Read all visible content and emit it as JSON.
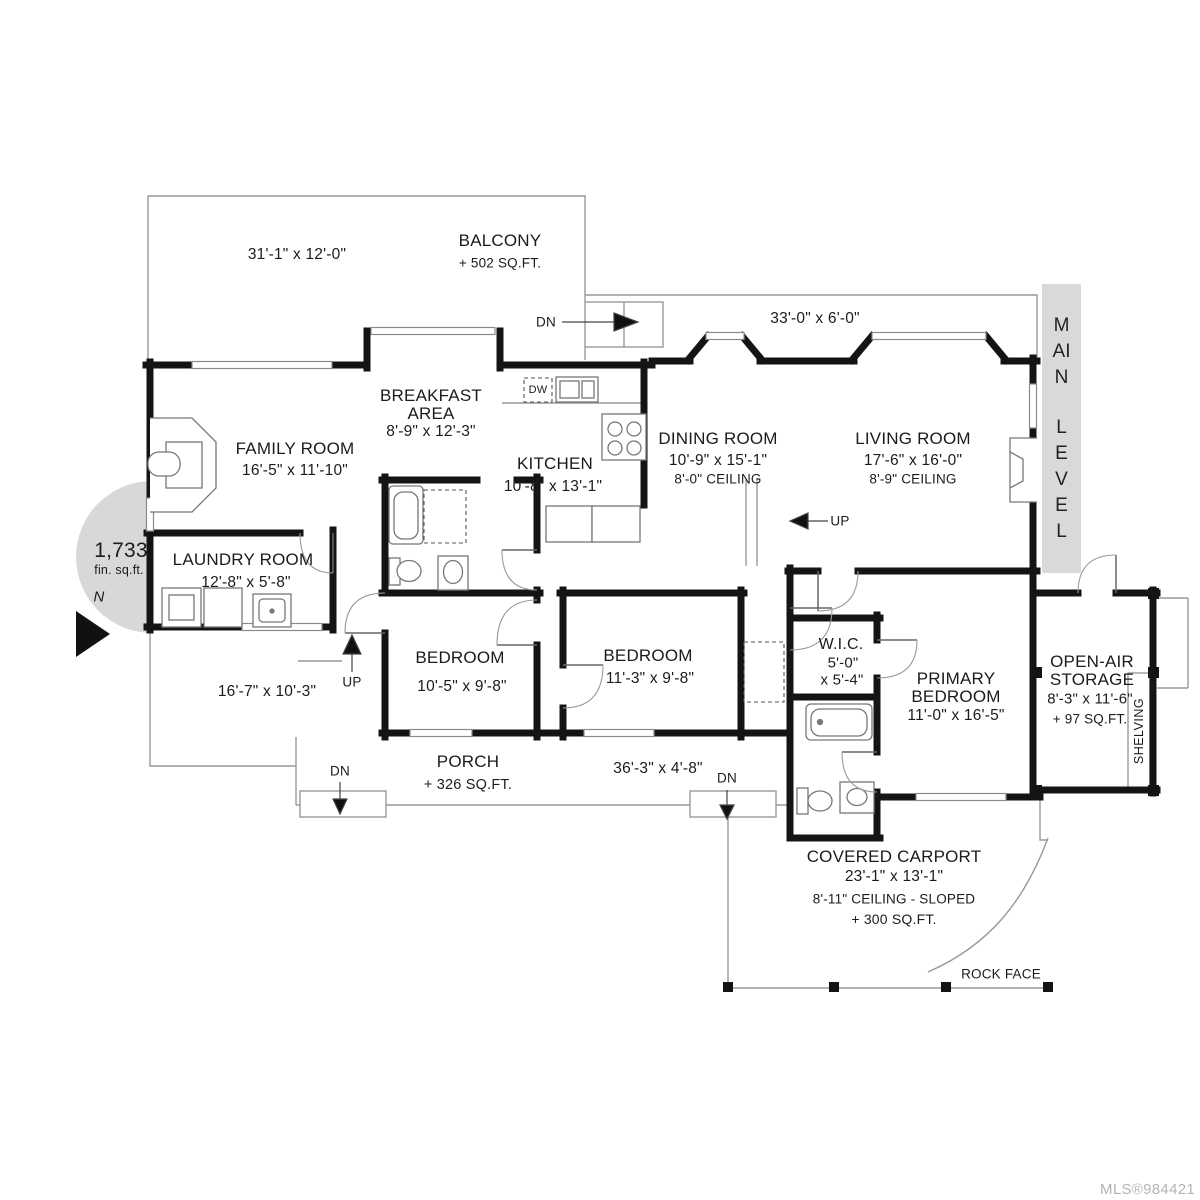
{
  "plan": {
    "level_band": [
      "MAIN",
      "LEVEL"
    ],
    "mls": "MLS®984421",
    "total_area": {
      "value": "1,733",
      "unit": "fin. sq.ft."
    },
    "north": "N",
    "shelving": "SHELVING",
    "rock_face": "ROCK FACE",
    "dw": "DW"
  },
  "stairs": {
    "dn_top": "DN",
    "up_mid": "UP",
    "up_porch": "UP",
    "dn_porch_left": "DN",
    "dn_porch_right": "DN"
  },
  "rooms": {
    "balcony": {
      "name": "BALCONY",
      "area": "+ 502 SQ.FT.",
      "dims": "31'-1\" x 12'-0\""
    },
    "upper_deck": {
      "dims": "33'-0\" x 6'-0\""
    },
    "family_room": {
      "name": "FAMILY ROOM",
      "dims": "16'-5\" x 11'-10\""
    },
    "breakfast_area": {
      "name": "BREAKFAST AREA",
      "dims": "8'-9\" x 12'-3\""
    },
    "kitchen": {
      "name": "KITCHEN",
      "dims": "10'-8\" x 13'-1\""
    },
    "dining_room": {
      "name": "DINING ROOM",
      "dims": "10'-9\" x 15'-1\"",
      "ceiling": "8'-0\" CEILING"
    },
    "living_room": {
      "name": "LIVING ROOM",
      "dims": "17'-6\" x 16'-0\"",
      "ceiling": "8'-9\" CEILING"
    },
    "laundry_room": {
      "name": "LAUNDRY ROOM",
      "dims": "12'-8\" x 5'-8\""
    },
    "side_deck": {
      "dims": "16'-7\" x 10'-3\""
    },
    "bedroom_1": {
      "name": "BEDROOM",
      "dims": "10'-5\" x 9'-8\""
    },
    "bedroom_2": {
      "name": "BEDROOM",
      "dims": "11'-3\" x 9'-8\""
    },
    "wic": {
      "name": "W.I.C.",
      "dims_line1": "5'-0\"",
      "dims_line2": "x 5'-4\""
    },
    "primary_bedroom": {
      "name": "PRIMARY BEDROOM",
      "dims": "11'-0\" x 16'-5\""
    },
    "open_air_storage": {
      "name": "OPEN-AIR STORAGE",
      "dims": "8'-3\" x 11'-6\"",
      "area": "+ 97 SQ.FT."
    },
    "porch": {
      "name": "PORCH",
      "area": "+ 326 SQ.FT.",
      "dims": "36'-3\" x 4'-8\""
    },
    "covered_carport": {
      "name": "COVERED CARPORT",
      "dims": "23'-1\" x 13'-1\"",
      "ceiling": "8'-11\" CEILING - SLOPED",
      "area": "+ 300 SQ.FT."
    }
  },
  "colors": {
    "wall": "#141414",
    "band_bg": "#d9d9d9",
    "area_circle": "#d8d8d8",
    "mls_text": "#b5b5b5"
  }
}
